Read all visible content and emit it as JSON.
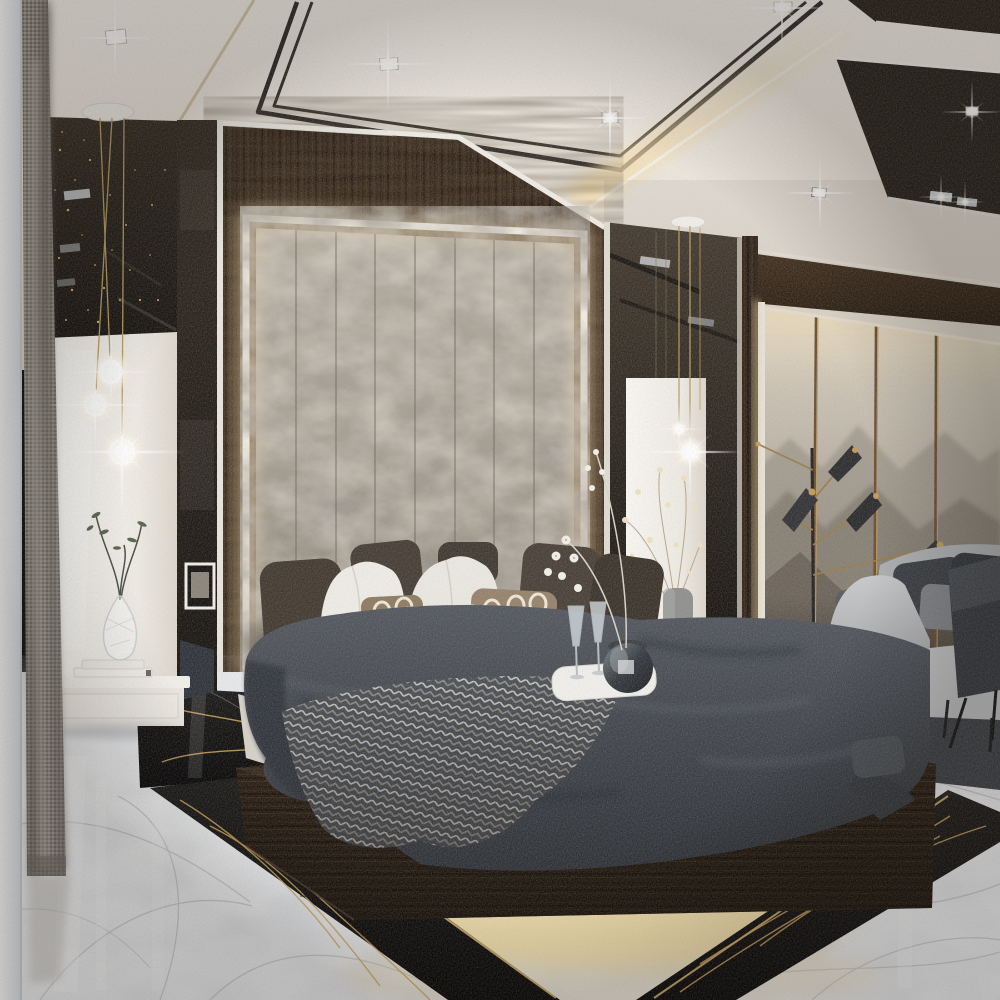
{
  "title": "Luxury modern bedroom - photorealistic 3D interior render",
  "note": "Photographic scene; contains no readable text, numbers or UI controls",
  "palette": {
    "ceiling_cream": "#efe9e1",
    "ceiling_trim_black": "#1b1713",
    "cove_light_warm": "#f7e2b2",
    "wall_wood_espresso": "#33251a",
    "headboard_velvet_taupe": "#aba293",
    "headboard_backlight": "#ffe2ab",
    "panel_gloss_white": "#f4f1ec",
    "smoked_mirror": "#221c16",
    "brass_gold": "#b28f50",
    "duvet_charcoal": "#3f434a",
    "throw_herringbone_gray": "#4b4e53",
    "pillow_white": "#f0ede7",
    "pillow_chain_bronze": "#907d62",
    "pillow_houndstooth_dark": "#3d3b38",
    "platform_wood_dark": "#2f2216",
    "underglow_warm": "#f6e2ae",
    "floor_marble_white": "#f3f4f5",
    "floor_vein_gray": "#a9aeb6",
    "inlay_marble_black": "#121110",
    "inlay_vein_gold": "#d2a75c",
    "sofa_light_gray": "#bcbdbf",
    "rug_charcoal": "#383c42",
    "art_linen_beige": "#cfc5b5",
    "art_mountain_gray": "#857c71",
    "curtain_gray_weave": "#8a847c",
    "side_wall_white": "#eef2f6"
  },
  "lighting": {
    "ceiling_recessed_spotlights": {
      "count": 6,
      "flare": "four-point star sparkle",
      "color": "#ffffff"
    },
    "recess_reflection_lights": {
      "count": 2
    },
    "cove_strip": {
      "description": "warm LED cove along stepped ceiling recess",
      "color": "#f7e2b2"
    },
    "headboard_halo": {
      "description": "warm LED backlight framing the velvet headboard panel",
      "color": "#ffe2ab"
    },
    "pendant_globes": {
      "left_cluster": 3,
      "right_cluster": 2,
      "style": "glowing frosted glass spheres on brass drop wires"
    },
    "platform_underglow": {
      "description": "warm LED strip under floating bed platform spilling onto marble",
      "color": "#f6e2ae"
    }
  },
  "architecture": {
    "ceiling": {
      "style": "stepped gypsum ceiling in cream with double black pin-stripe recess trim",
      "trim_lines": 2
    },
    "feature_wall": {
      "material": "dark espresso wood veneer, vertical grain"
    },
    "mirror_panels": {
      "left": "smoked bronze mirror with gold sparkle glints and reflected ceiling lights",
      "center_column": "smoked mirror column with brass pendant wires",
      "right": "full-height mirror wall reflecting the lounge area"
    },
    "art_wall": {
      "panels": 4,
      "motif": "misty layered mountain landscape on backlit linen",
      "dividers": "bronze strips",
      "mountain_layers": 3
    },
    "floor": {
      "field": "polished white Calacatta-style marble",
      "inlay": "black Nero-Marquina border band with gold veining and brass trim line"
    },
    "curtain": {
      "position": "far left",
      "fabric": "gray woven drape"
    }
  },
  "furniture": {
    "bed": {
      "type": "low floating platform bed in dark wood",
      "bedding": "charcoal linen duvet",
      "throw": "gray herringbone knit draped across the foot",
      "pillows": {
        "velvet_dark": 5,
        "white_cotton": 2,
        "bronze_chain_pattern": 2,
        "houndstooth": 1
      },
      "headboard": {
        "type": "channel-tufted crushed-velvet wall panel",
        "channels": 8,
        "frame": "white lacquer with warm LED halo"
      }
    },
    "nightstands": {
      "count": 2,
      "style": "floating white marble drawer units",
      "left_top_items": [
        "crystal vase with green sprigs",
        "two stacked books"
      ],
      "right_top_items": [
        "gray ceramic vase with cream blossom branches"
      ]
    },
    "sofa": {
      "position": "right reflected lounge",
      "upholstery": "light gray fabric",
      "cushions": 4,
      "legs": "black metal"
    },
    "console": {
      "position": "far right edge",
      "finish": "dark anthracite with black splayed legs"
    },
    "floor_lamp": {
      "style": "mid-century multi-arm",
      "shades": 4,
      "shade_color": "black",
      "arms": "brass"
    },
    "rug": {
      "color": "charcoal",
      "position": "under lounge sofa"
    }
  },
  "decor": {
    "bed_tray": {
      "tray": "white",
      "items": [
        "two champagne flutes",
        "smoked-glass ice bucket",
        "white orchid stems"
      ]
    },
    "picture_frame": "white framed photo reflected in left mirror strip",
    "gold_sparkles": "bokeh glints in the left smoked mirror"
  },
  "render_effects": [
    "four-point star lens flares on all lights",
    "glossy floor reflections",
    "soft film grain",
    "edge vignette"
  ]
}
